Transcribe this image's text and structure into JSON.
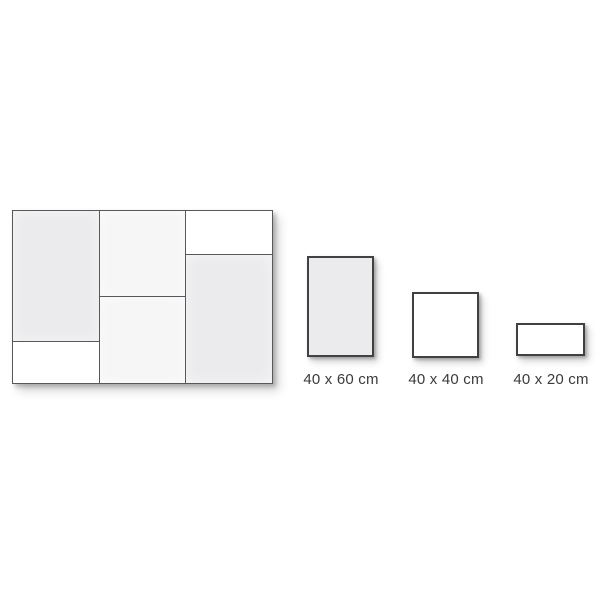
{
  "colors": {
    "background": "#ffffff",
    "outline": "#58585a",
    "sample_outline": "#414144",
    "label_text": "#3b3b3c",
    "tile_gray": "#ebebed",
    "tile_faint": "#f6f6f7",
    "tile_white": "#ffffff"
  },
  "composite": {
    "tiles": [
      {
        "position": "left-top",
        "size": "40 x 60 cm",
        "fill": "tile_gray"
      },
      {
        "position": "left-bottom",
        "size": "40 x 20 cm",
        "fill": "tile_white"
      },
      {
        "position": "middle-top",
        "size": "40 x 40 cm",
        "fill": "tile_faint"
      },
      {
        "position": "middle-bottom",
        "size": "40 x 40 cm",
        "fill": "tile_faint"
      },
      {
        "position": "right-top",
        "size": "40 x 20 cm",
        "fill": "tile_white"
      },
      {
        "position": "right-bottom",
        "size": "40 x 60 cm",
        "fill": "tile_gray"
      }
    ]
  },
  "sizes": [
    {
      "label": "40 x 60 cm",
      "fill": "tile_gray"
    },
    {
      "label": "40 x 40 cm",
      "fill": "tile_white"
    },
    {
      "label": "40 x 20 cm",
      "fill": "tile_white"
    }
  ]
}
